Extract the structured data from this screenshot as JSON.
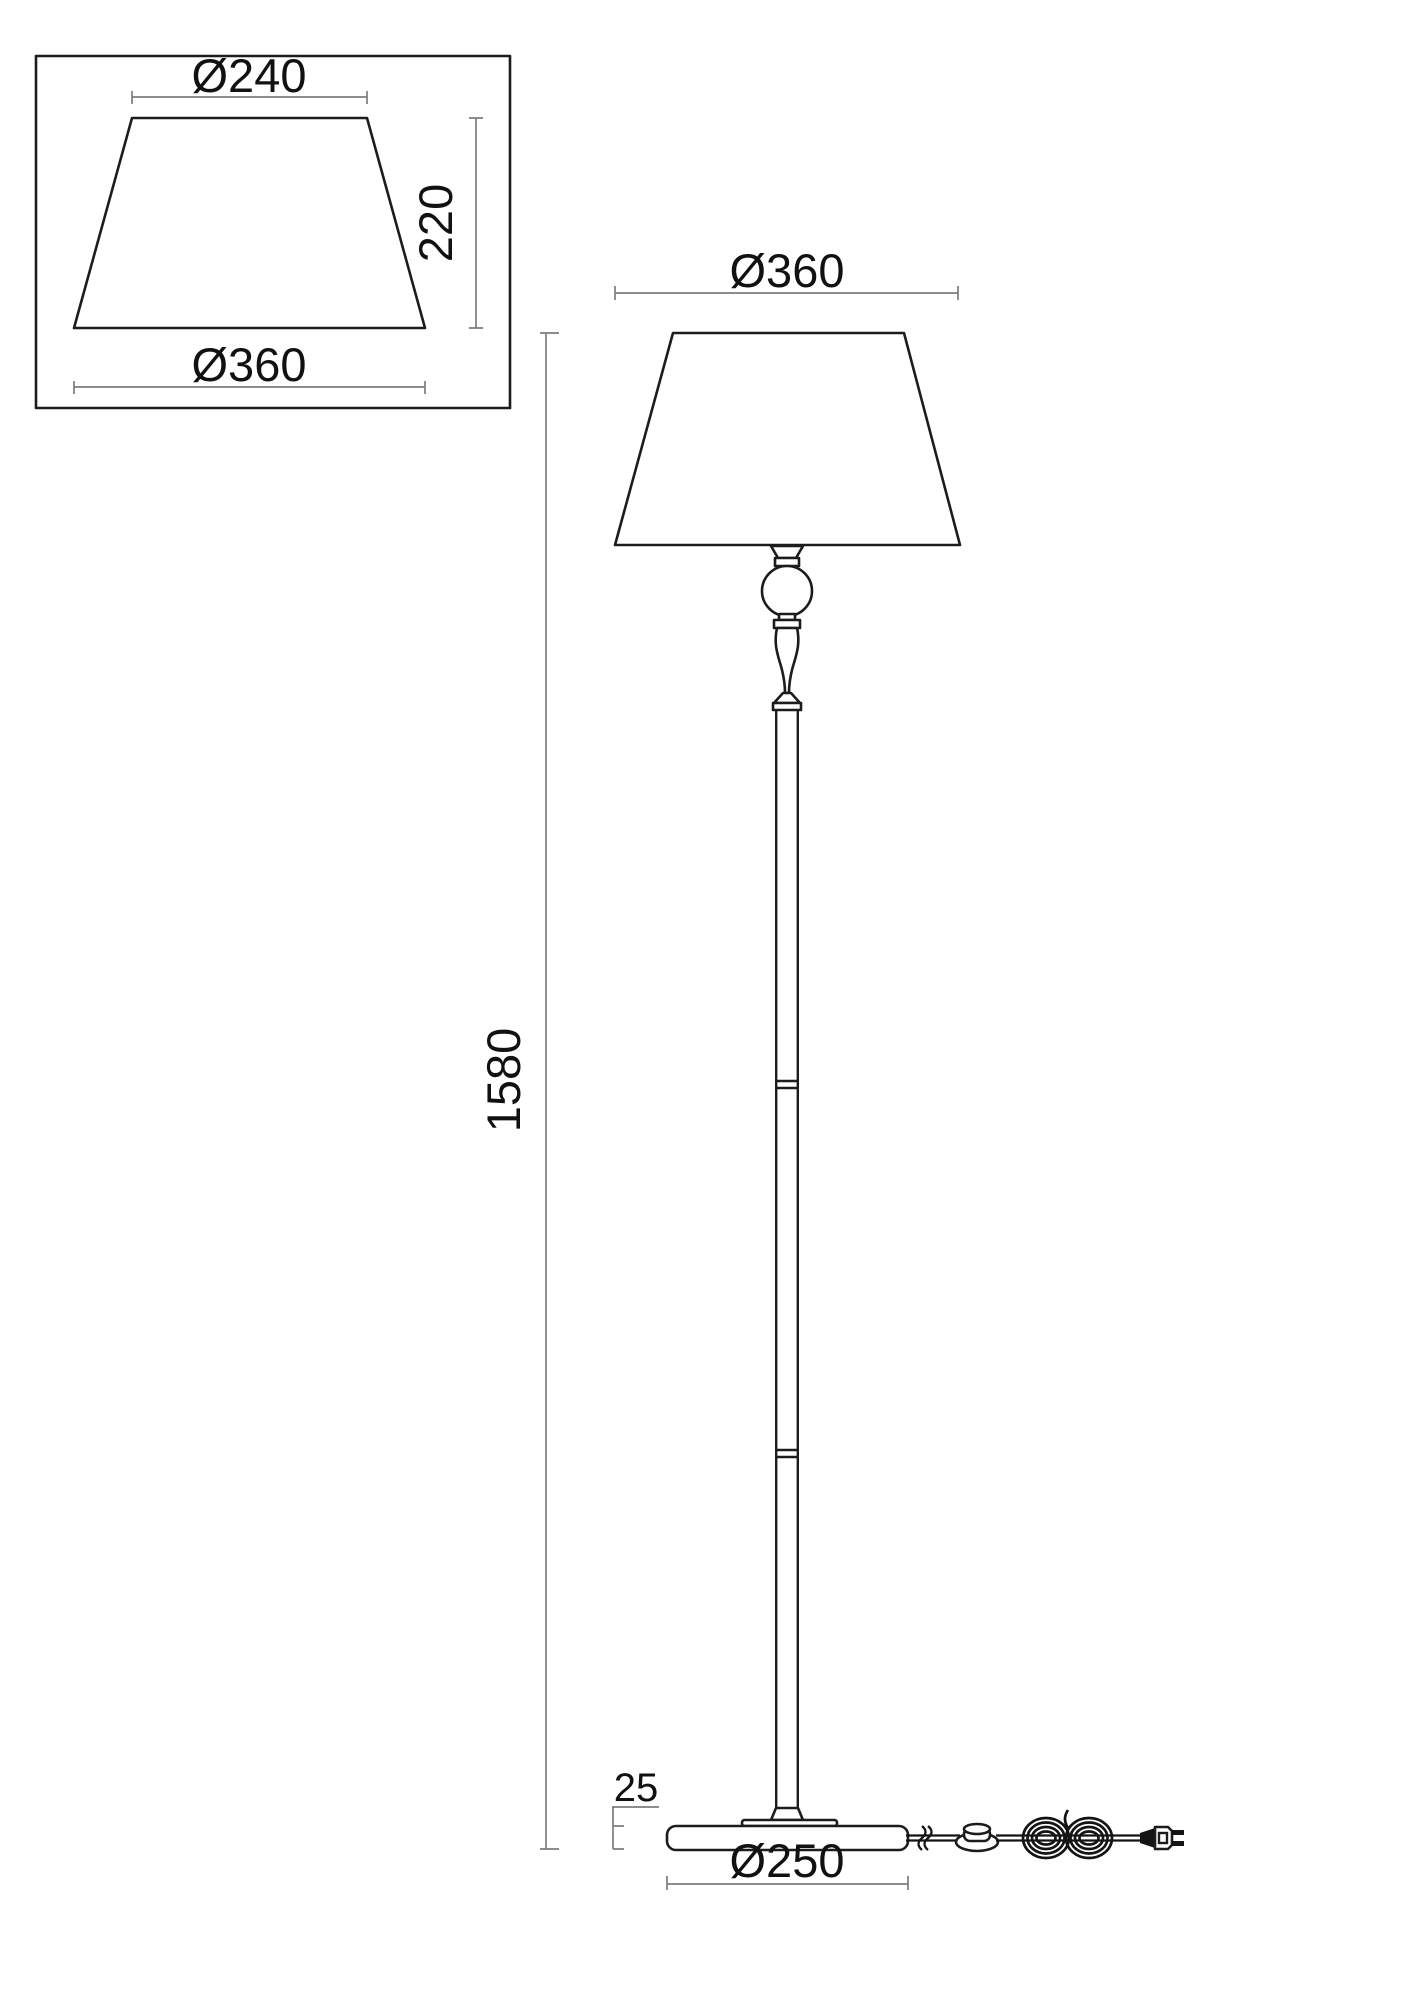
{
  "colors": {
    "outline": "#1c1c1c",
    "dimension_line": "#7d7d7d",
    "label_text": "#111111",
    "background": "#ffffff"
  },
  "shade_detail": {
    "top_diameter_label": "Ø240",
    "height_label": "220",
    "bottom_diameter_label": "Ø360"
  },
  "floor_lamp": {
    "shade_diameter_label": "Ø360",
    "overall_height_label": "1580",
    "base_thickness_label": "25",
    "base_diameter_label": "Ø250"
  }
}
